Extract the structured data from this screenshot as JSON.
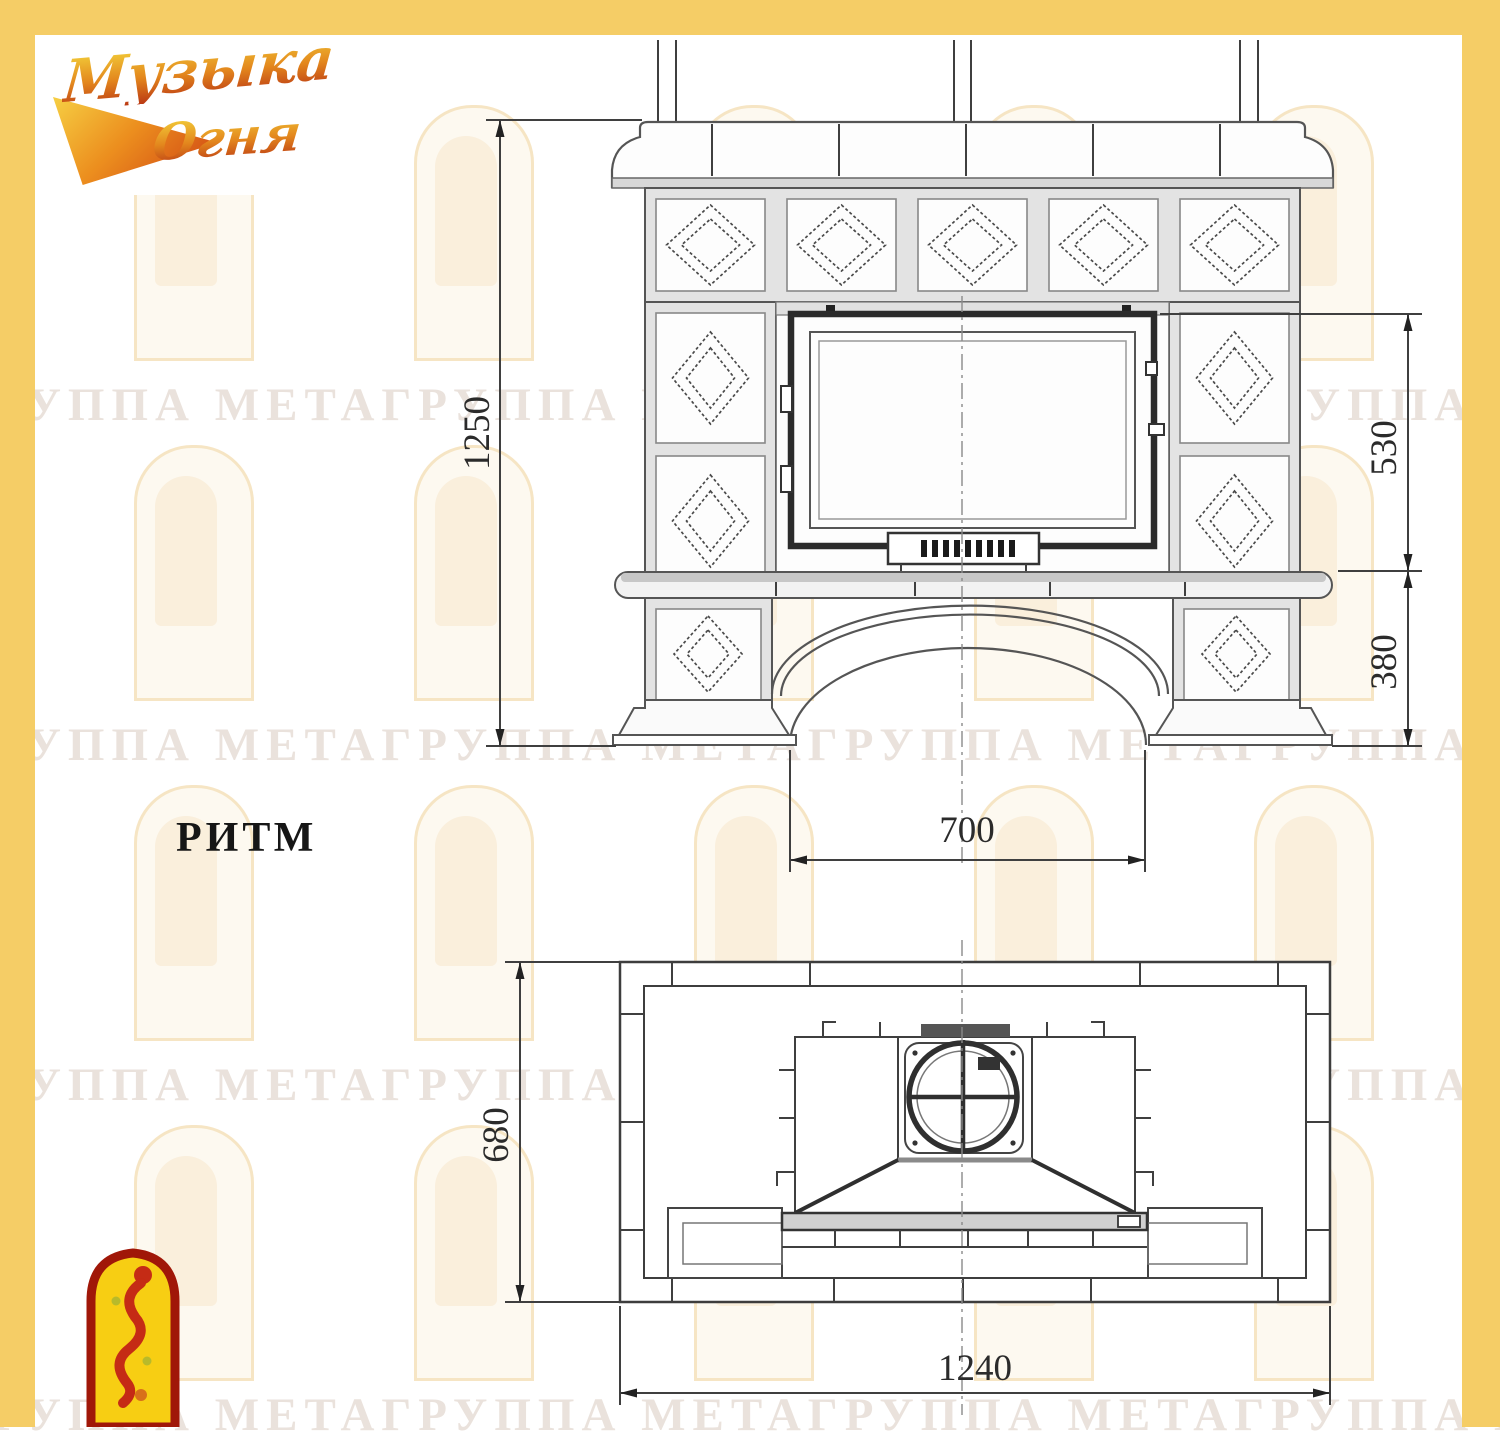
{
  "page": {
    "frame_color": "#f5cd66",
    "background": "#ffffff"
  },
  "logo": {
    "line1": "Музыка",
    "line2": "Огня"
  },
  "title": {
    "model_name": "РИТМ"
  },
  "front_view": {
    "dims": {
      "overall_height": "1250",
      "firebox_height": "530",
      "base_height": "380",
      "opening_width": "700"
    }
  },
  "plan_view": {
    "dims": {
      "depth": "680",
      "overall_width": "1240"
    }
  },
  "watermark": {
    "row_text": "ГРУППА МЕТАГРУППА МЕТАГРУППА МЕТАГРУППА МЕТА"
  },
  "emblem": {
    "fill_color": "#f7ce13",
    "border_color": "#a01708",
    "figure_color": "#c52b15"
  }
}
